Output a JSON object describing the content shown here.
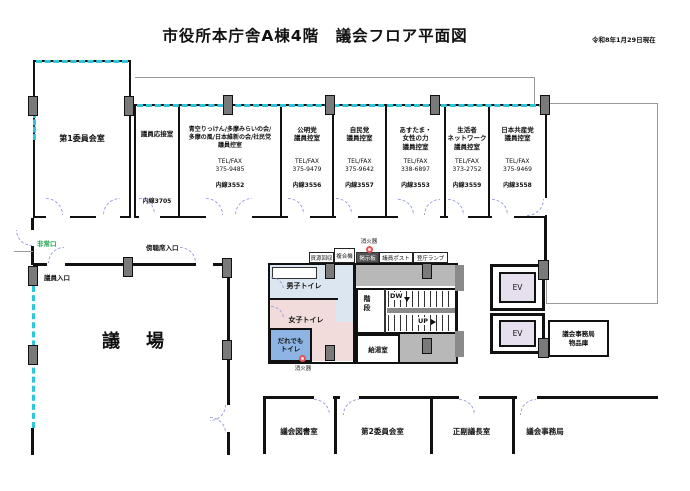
{
  "header": {
    "title": "市役所本庁舎A棟4階　議会フロア平面図",
    "date": "令和8年1月29日現在"
  },
  "rooms": {
    "committee1": {
      "name": "第1委員会室"
    },
    "reception": {
      "name": "議員応接室",
      "ext": "内線3705"
    },
    "party": [
      {
        "name": "青空りっけん/多摩みらいの会/\n多摩の風/日本維新の会/社民党\n議員控室",
        "tel": "TEL/FAX\n375-9485",
        "ext": "内線3552"
      },
      {
        "name": "公明党\n議員控室",
        "tel": "TEL/FAX\n375-9479",
        "ext": "内線3556"
      },
      {
        "name": "自民党\n議員控室",
        "tel": "TEL/FAX\n375-9642",
        "ext": "内線3557"
      },
      {
        "name": "あすたま・\n女性の力\n議員控室",
        "tel": "TEL/FAX\n338-6897",
        "ext": "内線3553"
      },
      {
        "name": "生活者\nネットワーク\n議員控室",
        "tel": "TEL/FAX\n373-2752",
        "ext": "内線3559"
      },
      {
        "name": "日本共産党\n議員控室",
        "tel": "TEL/FAX\n375-9469",
        "ext": "内線3558"
      }
    ],
    "hall": {
      "name": "議　場"
    },
    "library": {
      "name": "議会図書室"
    },
    "committee2": {
      "name": "第2委員会室"
    },
    "chairs": {
      "name": "正副議長室"
    },
    "secretariat": {
      "name": "議会事務局"
    },
    "storage": {
      "name": "議会事務局\n物品庫"
    }
  },
  "facilities": {
    "mens": "男子トイレ",
    "womens": "女子トイレ",
    "accessible": "だれでも\nトイレ",
    "stairs": "階\n段",
    "down": "DW",
    "up": "UP",
    "kitchen": "給湯室",
    "elevator": "EV"
  },
  "corridor_items": {
    "recycle": "資源回収",
    "copier": "複合機",
    "board": "掲示板",
    "post": "議員ポスト",
    "lamp": "登庁ランプ"
  },
  "entrances": {
    "emergency": "非常口",
    "member": "議員入口",
    "gallery": "傍聴席入口"
  },
  "safety": {
    "extinguisher": "消火器"
  },
  "colors": {
    "accent_cyan": "#2ec6d8",
    "exit_green": "#1fa14a",
    "mens_blue": "#dce6f1",
    "womens_pink": "#f2dcdb",
    "accessible_blue": "#8db4e2",
    "ev_purple": "#e6e0ee",
    "area_gray": "#b8b8b8",
    "pillar_gray": "#7a7a7a",
    "extinguisher_red": "#e05555"
  }
}
